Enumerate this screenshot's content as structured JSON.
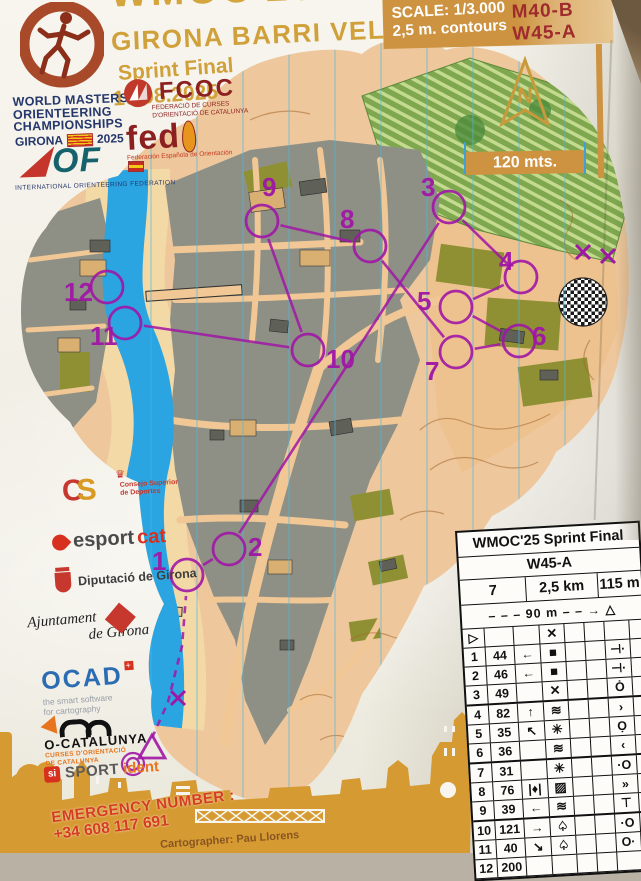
{
  "header": {
    "title": "WMOC'25",
    "subtitle": "GIRONA BARRI VELL",
    "event": "Sprint Final",
    "date": "10.08.2025",
    "wmoc_logo": {
      "line1": "WORLD MASTERS",
      "line2": "ORIENTEERING",
      "line3": "CHAMPIONSHIPS",
      "city": "GIRONA",
      "year": "2025"
    },
    "iof": {
      "name": "OF",
      "caption": "INTERNATIONAL ORIENTEERING FEDERATION"
    },
    "fcoc": {
      "name": "FCOC",
      "caption1": "FEDERACIÓ DE CURSES",
      "caption2": "D'ORIENTACIÓ DE CATALUNYA"
    },
    "fedo": {
      "name": "fed",
      "caption": "Federación Española de Orientación"
    }
  },
  "scale_panel": {
    "scale": "SCALE: 1/3.000",
    "contours": "2,5 m. contours",
    "class1": "M40-B",
    "class2": "W45-A",
    "north_letter": "N",
    "bar_label": "120 mts."
  },
  "sponsors": {
    "csd": {
      "mark_c": "C",
      "mark_s": "S",
      "crown": "♛",
      "caption": "Consejo Superior de Deportes"
    },
    "esportcat": {
      "part1": "esport",
      "part2": "cat"
    },
    "diputacio": {
      "text": "Diputació de Girona"
    },
    "ajuntament": {
      "text1": "Ajuntament",
      "text2": "de Girona"
    },
    "ocad": {
      "name": "OCAD",
      "tagline1": "the smart software",
      "tagline2": "for cartography"
    },
    "ocatalunya": {
      "name": "O-CATALUNYA",
      "caption1": "CURSES D'ORIENTACIÓ",
      "caption2": "DE CATALUNYA"
    },
    "sportident": {
      "si": "si",
      "part1": "SPORT",
      "part2": "ident"
    }
  },
  "emergency": {
    "label": "EMERGENCY NUMBER :",
    "phone": "+34 608 117 691"
  },
  "cartographer": "Cartographer: Pau Llorens",
  "descriptions": {
    "title": "WMOC'25 Sprint Final",
    "class": "W45-A",
    "course_number": "7",
    "length": "2,5 km",
    "climb": "115 m",
    "route": {
      "pre": "– – –",
      "dist": "90 m",
      "post": "– – →",
      "finish": "△"
    },
    "rows": [
      [
        "▷",
        "",
        "",
        "✕",
        "",
        "",
        "",
        ""
      ],
      [
        "1",
        "44",
        "←",
        "■",
        "",
        "",
        "⊣·",
        ""
      ],
      [
        "2",
        "46",
        "←",
        "■",
        "",
        "",
        "⊣·",
        ""
      ],
      [
        "3",
        "49",
        "",
        "✕",
        "",
        "",
        "Ȯ",
        ""
      ],
      [
        "4",
        "82",
        "↑",
        "≋",
        "",
        "",
        "›",
        ""
      ],
      [
        "5",
        "35",
        "↖",
        "✳",
        "",
        "",
        "Ọ",
        ""
      ],
      [
        "6",
        "36",
        "",
        "≋",
        "",
        "",
        "‹",
        ""
      ],
      [
        "7",
        "31",
        "",
        "✳",
        "",
        "",
        "·O",
        ""
      ],
      [
        "8",
        "76",
        "|♦|",
        "▨",
        "",
        "",
        "»",
        ""
      ],
      [
        "9",
        "39",
        "←",
        "≋",
        "",
        "",
        "⊤",
        ""
      ],
      [
        "10",
        "121",
        "→",
        "♤",
        "",
        "",
        "·O",
        ""
      ],
      [
        "11",
        "40",
        "↘",
        "♤",
        "",
        "",
        "O·",
        ""
      ],
      [
        "12",
        "200",
        "",
        "",
        "",
        "",
        "",
        ""
      ]
    ]
  },
  "course": {
    "color": "#a016a6",
    "controls": [
      {
        "n": "1",
        "x": 187,
        "y": 575,
        "lx": 152,
        "ly": 570
      },
      {
        "n": "2",
        "x": 229,
        "y": 549,
        "lx": 248,
        "ly": 556
      },
      {
        "n": "3",
        "x": 449,
        "y": 207,
        "lx": 421,
        "ly": 196
      },
      {
        "n": "4",
        "x": 521,
        "y": 277,
        "lx": 499,
        "ly": 270
      },
      {
        "n": "5",
        "x": 456,
        "y": 307,
        "lx": 417,
        "ly": 310
      },
      {
        "n": "6",
        "x": 519,
        "y": 341,
        "lx": 532,
        "ly": 345
      },
      {
        "n": "7",
        "x": 456,
        "y": 352,
        "lx": 425,
        "ly": 380
      },
      {
        "n": "8",
        "x": 370,
        "y": 246,
        "lx": 340,
        "ly": 228
      },
      {
        "n": "9",
        "x": 262,
        "y": 221,
        "lx": 262,
        "ly": 196
      },
      {
        "n": "10",
        "x": 308,
        "y": 350,
        "lx": 326,
        "ly": 368
      },
      {
        "n": "11",
        "x": 125,
        "y": 323,
        "lx": 90,
        "ly": 345
      },
      {
        "n": "12",
        "x": 107,
        "y": 287,
        "lx": 64,
        "ly": 301
      }
    ],
    "start": {
      "x": 152,
      "y": 749
    },
    "finish": {
      "x": 133,
      "y": 764
    },
    "route_points": [
      [
        152,
        738
      ],
      [
        168,
        702
      ],
      [
        182,
        646
      ],
      [
        186,
        596
      ]
    ],
    "crosses": [
      {
        "x": 178,
        "y": 698
      },
      {
        "x": 583,
        "y": 252
      },
      {
        "x": 608,
        "y": 256
      }
    ]
  }
}
